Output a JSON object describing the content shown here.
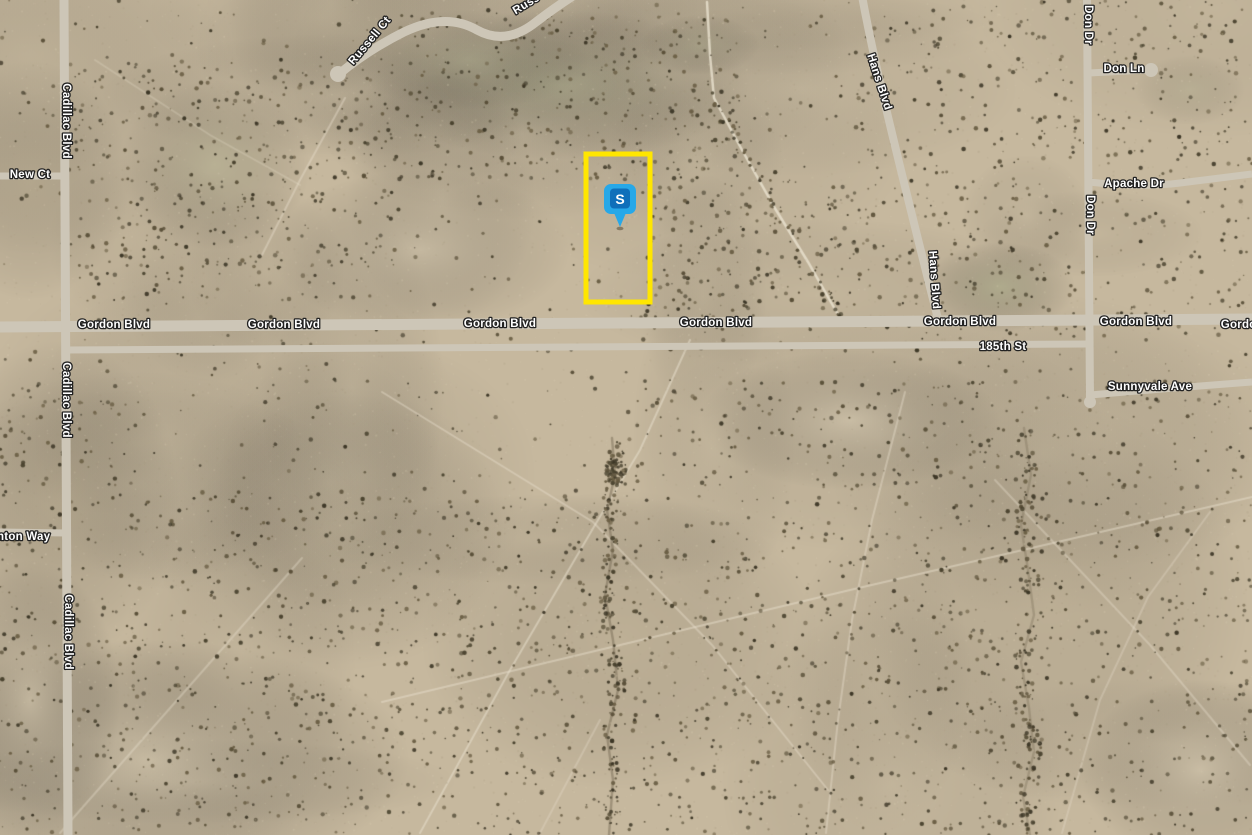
{
  "map": {
    "view_type": "satellite",
    "colors": {
      "terrain_base": "#c6b89e",
      "road": "#cdc6b7",
      "label_fill": "#ffffff",
      "label_casing": "#222222",
      "parcel_outline": "#ffe600",
      "marker_blue": "#27a8e8",
      "marker_badge_blue": "#0f6fba",
      "bush_dark": "#3c3626"
    },
    "parcel_outline": {
      "x": 586,
      "y": 154,
      "width": 64,
      "height": 148,
      "stroke_width": 5,
      "color": "#ffe600"
    },
    "marker": {
      "label": "S",
      "x": 620,
      "y": 227,
      "color": "#27a8e8",
      "badge_color": "#0f6fba"
    },
    "road_labels": [
      {
        "text": "Cadillac Blvd",
        "x": 66,
        "y": 121,
        "rotate": 90
      },
      {
        "text": "Cadillac Blvd",
        "x": 66,
        "y": 400,
        "rotate": 90
      },
      {
        "text": "Cadillac Blvd",
        "x": 68,
        "y": 632,
        "rotate": 90
      },
      {
        "text": "New Ct",
        "x": 30,
        "y": 175,
        "rotate": 0
      },
      {
        "text": "nton Way",
        "x": -3,
        "y": 537,
        "rotate": 0,
        "anchor": "start"
      },
      {
        "text": "Russell Ct",
        "x": 370,
        "y": 41,
        "rotate": -50
      },
      {
        "text": "Russell Ct",
        "x": 514,
        "y": 12,
        "rotate": -31,
        "anchor": "start"
      },
      {
        "text": "Hans Blvd",
        "x": 879,
        "y": 82,
        "rotate": 72
      },
      {
        "text": "Hans Blvd",
        "x": 934,
        "y": 280,
        "rotate": 86
      },
      {
        "text": "Don Dr",
        "x": 1088,
        "y": 25,
        "rotate": 90
      },
      {
        "text": "Don Dr",
        "x": 1090,
        "y": 215,
        "rotate": 90
      },
      {
        "text": "Don Ln",
        "x": 1124,
        "y": 69,
        "rotate": 0
      },
      {
        "text": "Apache Dr",
        "x": 1134,
        "y": 184,
        "rotate": 0
      },
      {
        "text": "Gordon Blvd",
        "x": 114,
        "y": 325,
        "rotate": 0
      },
      {
        "text": "Gordon Blvd",
        "x": 284,
        "y": 325,
        "rotate": 0
      },
      {
        "text": "Gordon Blvd",
        "x": 500,
        "y": 324,
        "rotate": 0
      },
      {
        "text": "Gordon Blvd",
        "x": 716,
        "y": 323,
        "rotate": 0
      },
      {
        "text": "Gordon Blvd",
        "x": 960,
        "y": 322,
        "rotate": 0
      },
      {
        "text": "Gordon Blvd",
        "x": 1136,
        "y": 322,
        "rotate": 0
      },
      {
        "text": "Gordon Blvd",
        "x": 1257,
        "y": 325,
        "rotate": 0
      },
      {
        "text": "185th St",
        "x": 1003,
        "y": 347,
        "rotate": 0
      },
      {
        "text": "Sunnyvale Ave",
        "x": 1150,
        "y": 387,
        "rotate": 0
      }
    ]
  }
}
